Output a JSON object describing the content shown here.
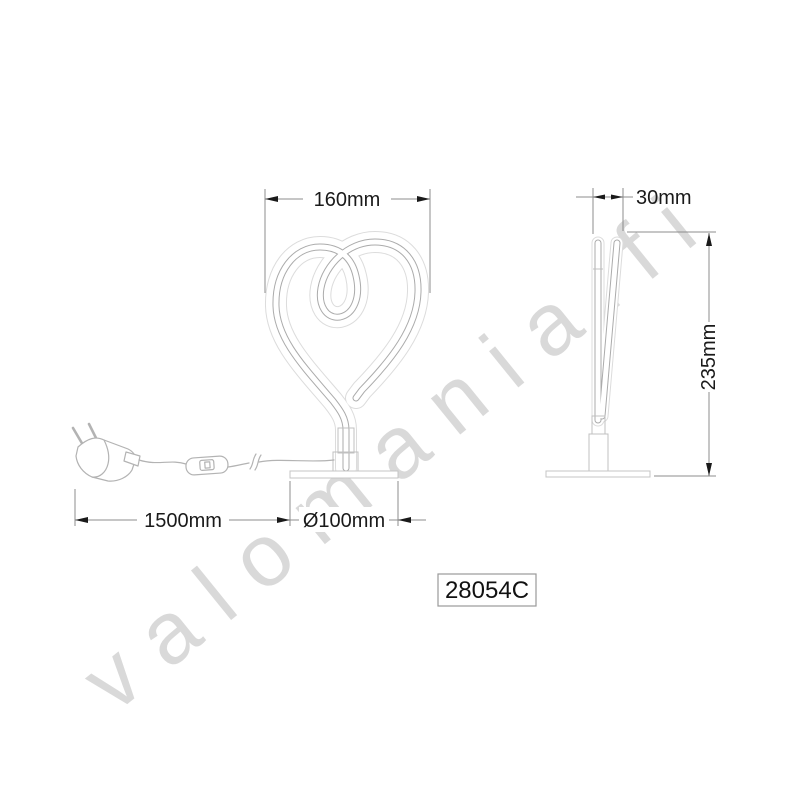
{
  "watermark": {
    "text": "valomania.fi"
  },
  "product_code": {
    "label": "28054C"
  },
  "dimensions": {
    "front_width": "160mm",
    "side_depth": "30mm",
    "height": "235mm",
    "cable_length": "1500mm",
    "base_diameter": "Ø100mm"
  },
  "colors": {
    "tube_line": "#ababab",
    "tube_glow": "#dcdcdc",
    "hardware_line": "#b3b3b3",
    "dimension_line": "#8c8c8c",
    "dimension_text": "#1a1a1a",
    "watermark": "#b9b9b9",
    "background": "#ffffff"
  }
}
